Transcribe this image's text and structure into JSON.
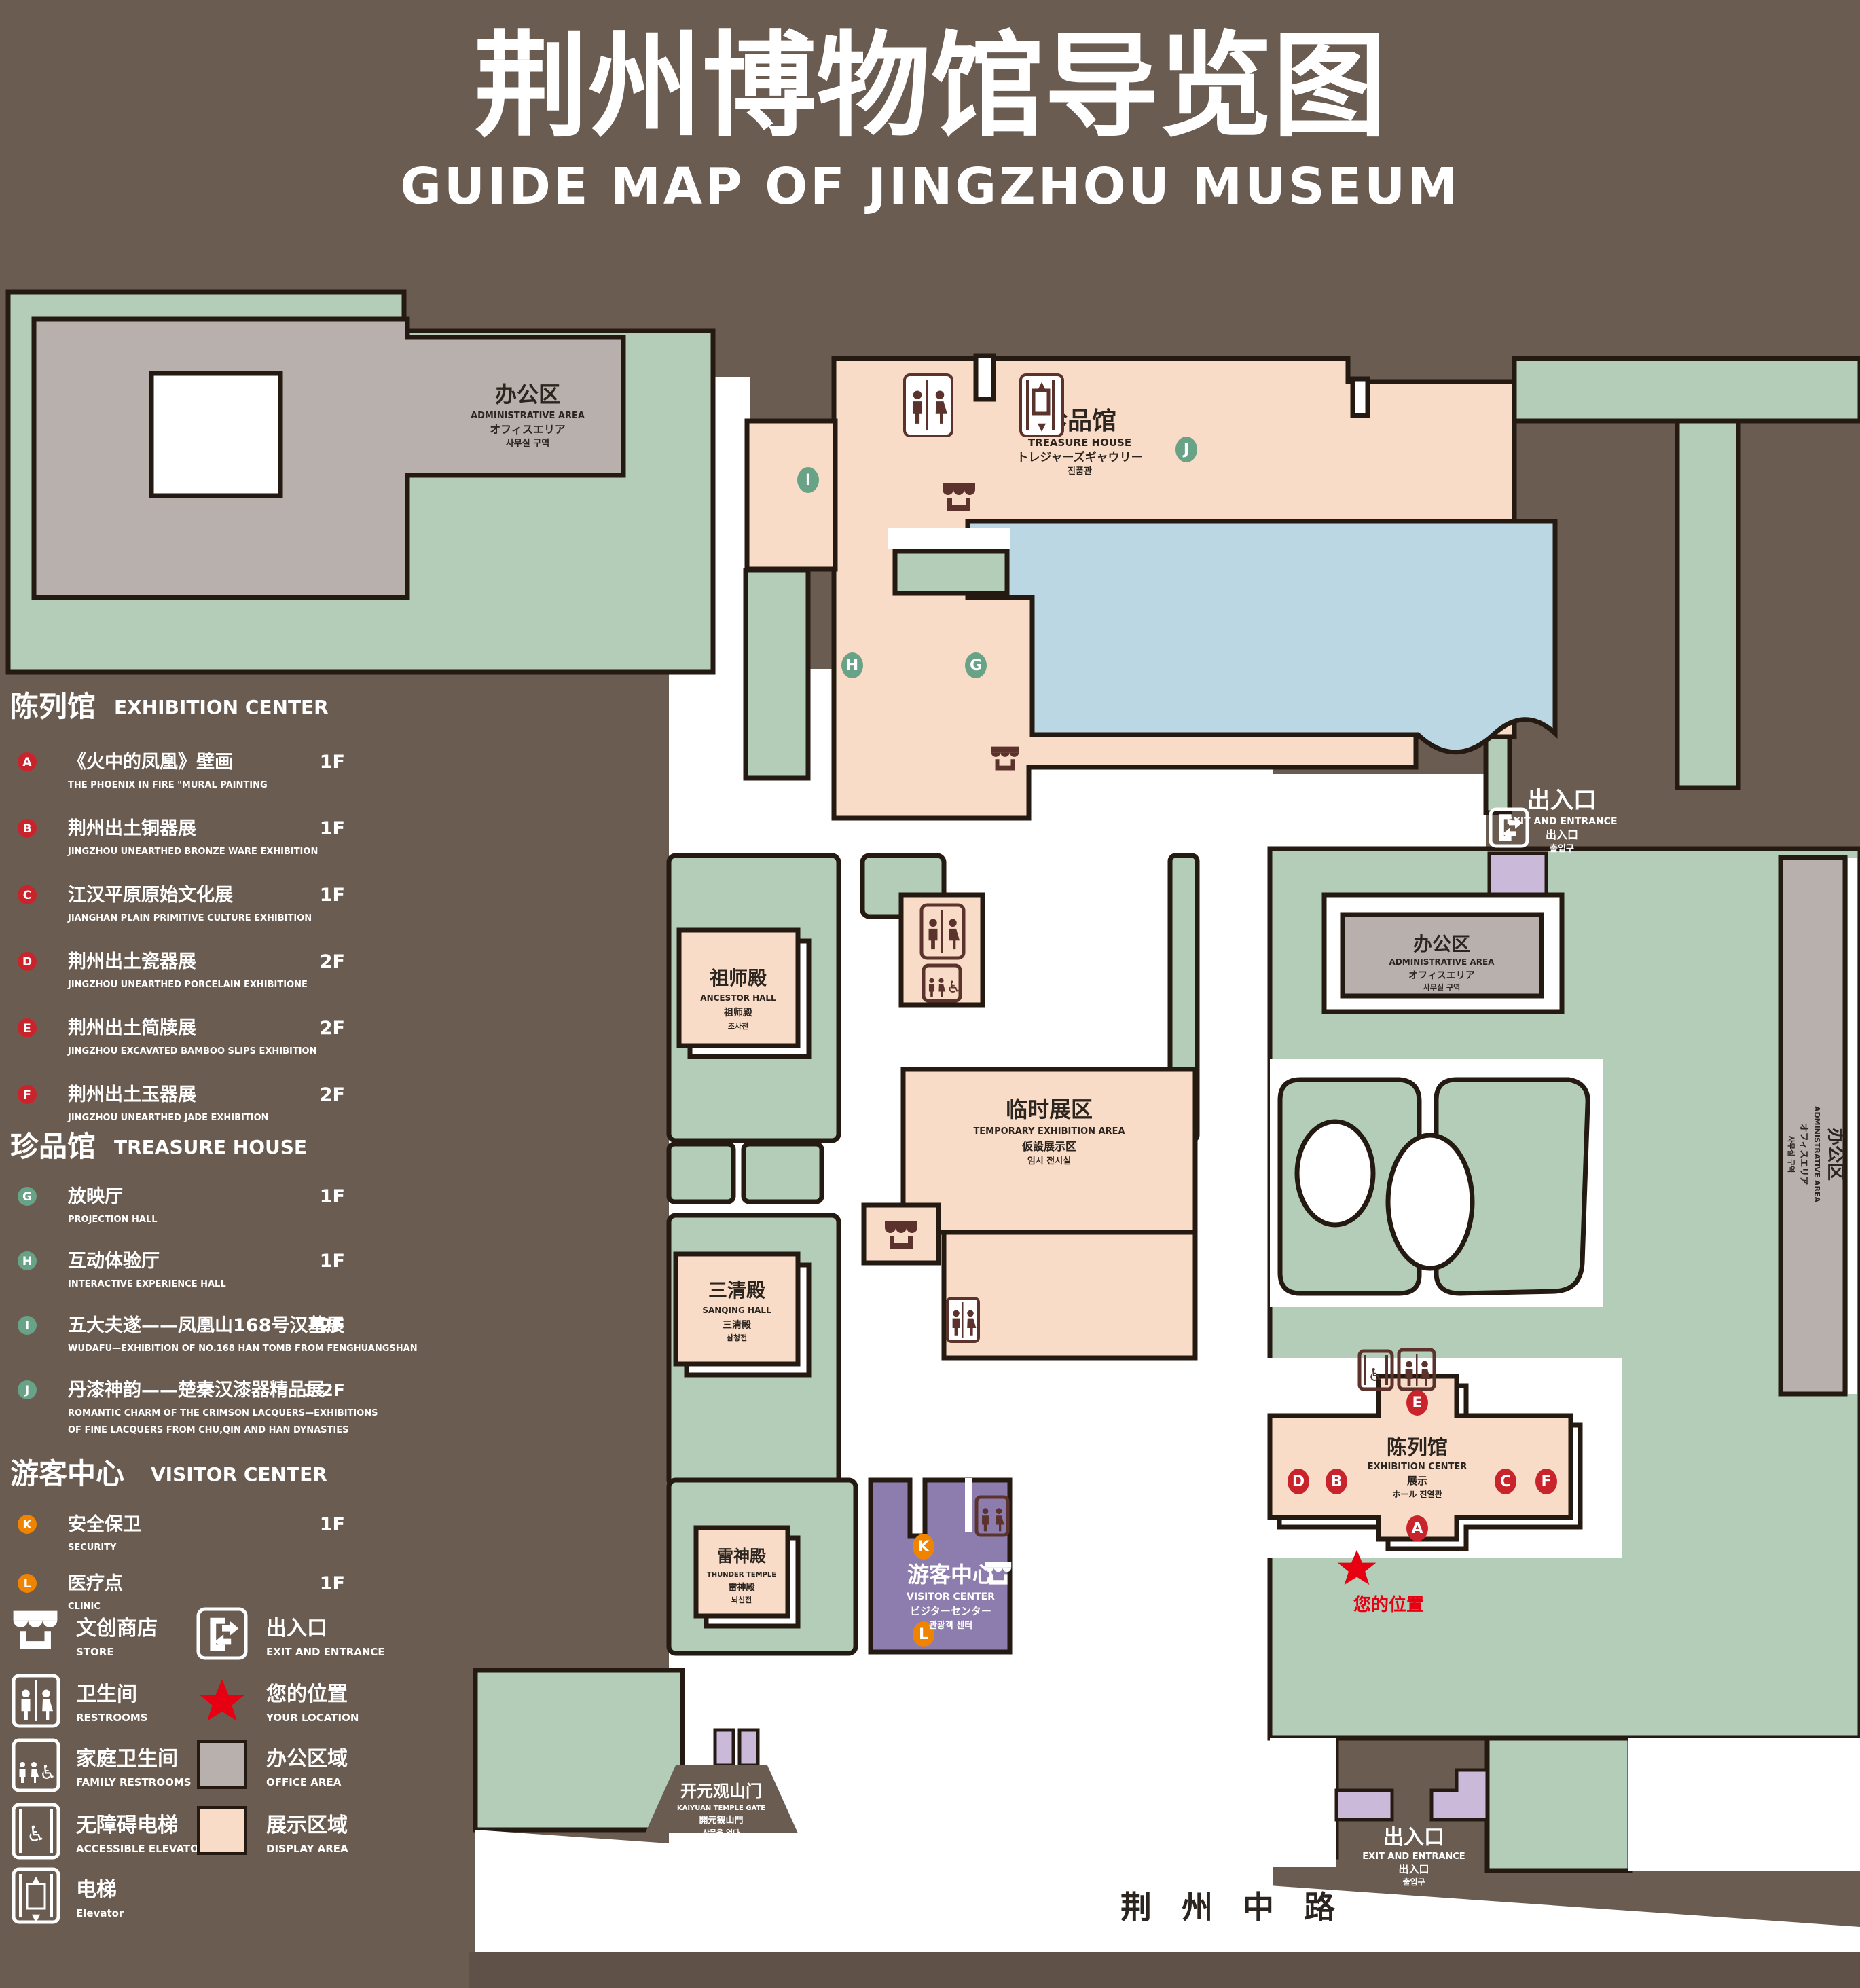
{
  "title": {
    "zh": "荆州博物馆导览图",
    "en": "GUIDE MAP OF JINGZHOU MUSEUM"
  },
  "legend": {
    "sections": [
      {
        "zh": "陈列馆",
        "en": "EXHIBITION CENTER",
        "items": [
          {
            "letter": "A",
            "zh": "《火中的凤凰》壁画",
            "en": "THE PHOENIX IN FIRE \"MURAL PAINTING",
            "floor": "1F"
          },
          {
            "letter": "B",
            "zh": "荆州出土铜器展",
            "en": "JINGZHOU UNEARTHED BRONZE WARE EXHIBITION",
            "floor": "1F"
          },
          {
            "letter": "C",
            "zh": "江汉平原原始文化展",
            "en": "JIANGHAN PLAIN PRIMITIVE CULTURE EXHIBITION",
            "floor": "1F"
          },
          {
            "letter": "D",
            "zh": "荆州出土瓷器展",
            "en": "JINGZHOU UNEARTHED PORCELAIN EXHIBITIONE",
            "floor": "2F"
          },
          {
            "letter": "E",
            "zh": "荆州出土简牍展",
            "en": "JINGZHOU EXCAVATED BAMBOO SLIPS EXHIBITION",
            "floor": "2F"
          },
          {
            "letter": "F",
            "zh": "荆州出土玉器展",
            "en": "JINGZHOU UNEARTHED JADE EXHIBITION",
            "floor": "2F"
          }
        ]
      },
      {
        "zh": "珍品馆",
        "en": "TREASURE HOUSE",
        "items": [
          {
            "letter": "G",
            "zh": "放映厅",
            "en": "PROJECTION HALL",
            "floor": "1F"
          },
          {
            "letter": "H",
            "zh": "互动体验厅",
            "en": "INTERACTIVE EXPERIENCE HALL",
            "floor": "1F"
          },
          {
            "letter": "I",
            "zh": "五大夫遂——凤凰山168号汉墓展",
            "en": "WUDAFU—EXHIBITION OF NO.168 HAN TOMB FROM FENGHUANGSHAN",
            "floor": "2F"
          },
          {
            "letter": "J",
            "zh": "丹漆神韵——楚秦汉漆器精品展",
            "en": "ROMANTIC CHARM OF THE CRIMSON LACQUERS—EXHIBITIONS",
            "en2": "OF FINE LACQUERS FROM CHU,QIN AND HAN DYNASTIES",
            "floor": "1-2F"
          }
        ]
      },
      {
        "zh": "游客中心",
        "en": "VISITOR CENTER",
        "items": [
          {
            "letter": "K",
            "zh": "安全保卫",
            "en": "SECURITY",
            "floor": "1F"
          },
          {
            "letter": "L",
            "zh": "医疗点",
            "en": "CLINIC",
            "floor": "1F"
          }
        ]
      }
    ],
    "symbols": {
      "store": {
        "zh": "文创商店",
        "en": "STORE"
      },
      "exit": {
        "zh": "出入口",
        "en": "EXIT AND ENTRANCE"
      },
      "restrooms": {
        "zh": "卫生间",
        "en": "RESTROOMS"
      },
      "your_location": {
        "zh": "您的位置",
        "en": "YOUR LOCATION"
      },
      "family_restrooms": {
        "zh": "家庭卫生间",
        "en": "FAMILY RESTROOMS"
      },
      "office_area": {
        "zh": "办公区域",
        "en": "OFFICE AREA"
      },
      "accessible_elevator": {
        "zh": "无障碍电梯",
        "en": "ACCESSIBLE ELEVATOR"
      },
      "display_area": {
        "zh": "展示区域",
        "en": "DISPLAY AREA"
      },
      "elevator": {
        "zh": "电梯",
        "en": "Elevator"
      }
    }
  },
  "map": {
    "buildings": {
      "admin_tl": {
        "zh": "办公区",
        "en": "ADMINISTRATIVE AREA",
        "jp": "オフィスエリア",
        "kr": "사무실 구역"
      },
      "treasure": {
        "zh": "珍品馆",
        "en": "TREASURE HOUSE",
        "jp": "トレジャーズギャウリー",
        "kr": "진품관"
      },
      "ancestor": {
        "zh": "祖师殿",
        "en": "ANCESTOR HALL",
        "jp": "祖师殿",
        "kr": "조사전"
      },
      "temporary": {
        "zh": "临时展区",
        "en": "TEMPORARY EXHIBITION AREA",
        "jp": "仮設展示区",
        "kr": "임시 전시실"
      },
      "admin_r": {
        "zh": "办公区",
        "en": "ADMINISTRATIVE AREA",
        "jp": "オフィスエリア",
        "kr": "사무실 구역"
      },
      "sanqing": {
        "zh": "三清殿",
        "en": "SANQING HALL",
        "jp": "三清殿",
        "kr": "삼청전"
      },
      "thunder": {
        "zh": "雷神殿",
        "en": "THUNDER TEMPLE",
        "jp": "雷神殿",
        "kr": "뇌신전"
      },
      "visitor": {
        "zh": "游客中心",
        "en": "VISITOR CENTER",
        "jp": "ビジターセンター",
        "kr": "관광객 센터"
      },
      "exhibition": {
        "zh": "陈列馆",
        "en": "EXHIBITION CENTER",
        "jp": "展示",
        "kr": "ホール 진열관"
      },
      "admin_strip": {
        "zh": "办公区",
        "en": "ADMINISTRATIVE AREA",
        "jp": "オフィスエリア",
        "kr": "사무실 구역"
      },
      "gate": {
        "zh": "开元观山门",
        "en": "KAIYUAN TEMPLE GATE",
        "jp": "開元観山門",
        "kr": "산문을 열다"
      }
    },
    "exit": {
      "zh": "出入口",
      "en": "EXIT AND ENTRANCE",
      "jp": "出入口",
      "kr": "출입구"
    },
    "road": "荆 州 中 路",
    "your_location": "您的位置",
    "markers": [
      "A",
      "B",
      "C",
      "D",
      "E",
      "F",
      "G",
      "H",
      "I",
      "J",
      "K",
      "L"
    ]
  },
  "colors": {
    "background": "#6b5c51",
    "display_area": "#f8dcc7",
    "office_area": "#b7b0ac",
    "green_space": "#b3cdb9",
    "water": "#bad7e3",
    "visitor_center": "#8d7cae",
    "entrance_block": "#cbb9da",
    "marker_red": "#c9242c",
    "marker_green": "#68a287",
    "marker_orange": "#f08300",
    "icon_maroon": "#5c332c",
    "location_red": "#e60012"
  }
}
